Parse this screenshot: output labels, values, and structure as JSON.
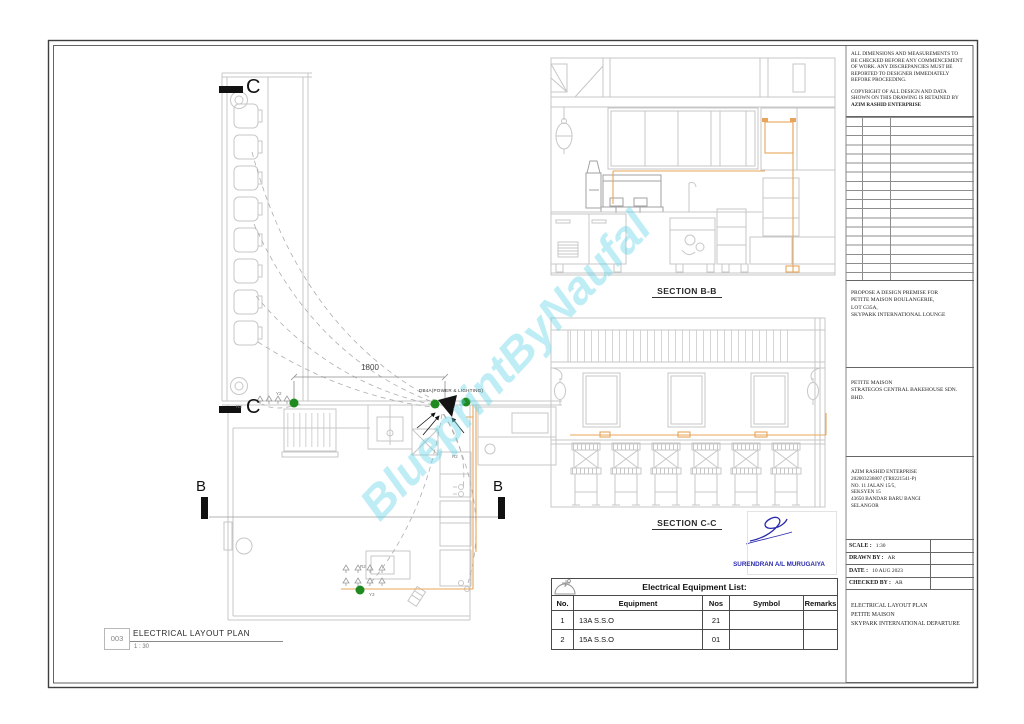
{
  "colors": {
    "line_light": "#c7c7c7",
    "line_dark": "#141414",
    "conduit_orange": "#e8a55a",
    "point_green": "#1f8a1f",
    "stamp_blue": "#2a2aac",
    "watermark_cyan": "rgba(99,211,231,0.42)"
  },
  "watermark": {
    "text": "BlueprintByNaufal"
  },
  "plan": {
    "marker_c": "C",
    "marker_b": "B",
    "dim": "1800",
    "db_label": "DB4A(POWER & LIGHTING)",
    "tags": {
      "r3": "R3",
      "y2": "Y2",
      "r2": "R2",
      "y3": "Y3",
      "r2b": "R2"
    },
    "title_no": "003",
    "title": "ELECTRICAL LAYOUT PLAN",
    "scale": "1 : 30"
  },
  "sections": {
    "bb": "SECTION B-B",
    "cc": "SECTION C-C"
  },
  "stamp": {
    "line1": "SURENDRAN A/L MURUGAIYA",
    "line2": "WIREMAN PW4",
    "line3": "PW-T-4-B-0697-2001"
  },
  "equipment_table": {
    "title": "Electrical Equipment List:",
    "headers": {
      "no": "No.",
      "equipment": "Equipment",
      "nos": "Nos",
      "symbol": "Symbol",
      "remarks": "Remarks"
    },
    "rows": [
      {
        "no": "1",
        "equipment": "13A S.S.O",
        "nos": "21"
      },
      {
        "no": "2",
        "equipment": "15A S.S.O",
        "nos": "01"
      }
    ]
  },
  "titleblock": {
    "note1": "ALL DIMENSIONS AND MEASUREMENTS TO\nBE CHECKED BEFORE ANY COMMENCEMENT\nOF WORK. ANY DISCREPANCIES MUST BE\nREPORTED TO DESIGNER IMMEDIATELY\nBEFORE PROCEEDING.",
    "note2": "COPYRIGHT OF ALL DESIGN AND DATA\nSHOWN ON THIS DRAWING IS RETAINED BY",
    "note2_bold": "AZIM RASHID ENTERPRISE",
    "project": "PROPOSE A DESIGN PREMISE FOR\nPETITE MAISON BOULANGERIE,\nLOT G35A,\nSKYPARK INTERNATIONAL LOUNGE",
    "client": "PETITE MAISON\nSTRATEGOS CENTRAL BAKEHOUSE SDN. BHD.",
    "consultant": "AZIM RASHID ENTERPRISE\n202003236807 (TR0221541-P)\nNO. 11 JALAN 15/5,\nSEKSYEN 15\n43650 BANDAR BARU BANGI\nSELANGOR",
    "scale_label": "SCALE :",
    "scale_value": "1:30",
    "drawn_label": "DRAWN BY :",
    "drawn_value": "AR",
    "date_label": "DATE :",
    "date_value": "10 AUG 2023",
    "checked_label": "CHECKED BY :",
    "checked_value": "AR",
    "drawing_title": "ELECTRICAL LAYOUT PLAN\nPETITE MAISON\nSKYPARK INTERNATIONAL DEPARTURE"
  }
}
